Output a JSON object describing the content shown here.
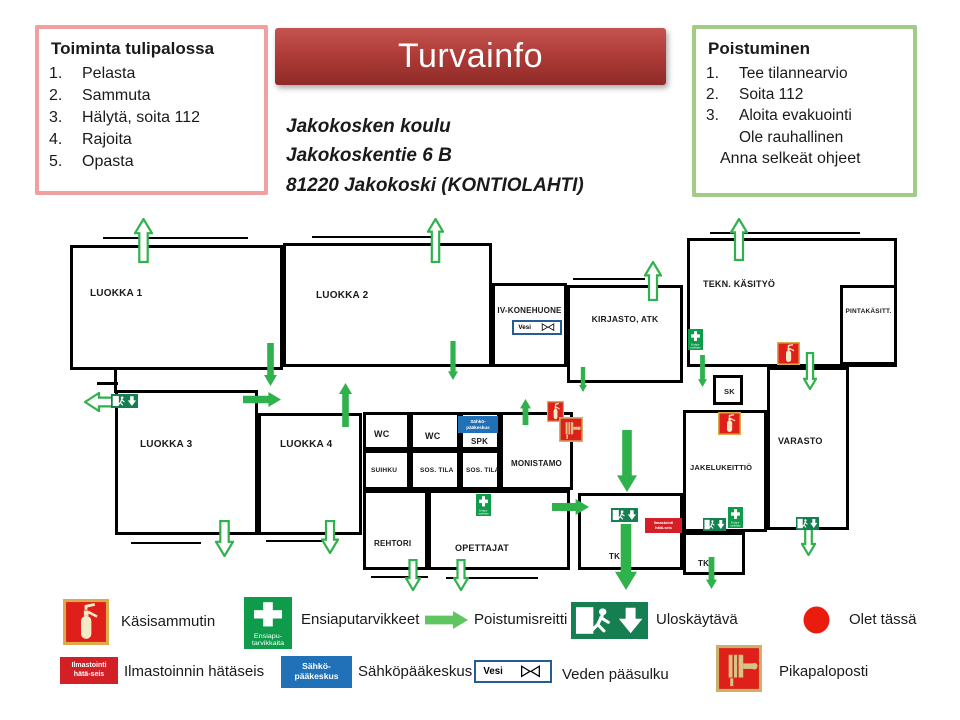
{
  "title": "Turvainfo",
  "address": {
    "line1": "Jakokosken koulu",
    "line2": "Jakokoskentie 6 B",
    "line3": "81220 Jakokoski (KONTIOLAHTI)"
  },
  "fire_instructions": {
    "title": "Toiminta  tulipalossa",
    "items": [
      "Pelasta",
      "Sammuta",
      "Hälytä, soita 112",
      "Rajoita",
      "Opasta"
    ]
  },
  "evacuation": {
    "title": "Poistuminen",
    "items": [
      "Tee tilannearvio",
      "Soita 112",
      "Aloita evakuointi"
    ],
    "extra1": "Ole rauhallinen",
    "extra2": "Anna selkeät ohjeet"
  },
  "colors": {
    "banner_red": "#b03c38",
    "pink_border": "#f0a0a0",
    "green_border": "#a2cb85",
    "route_green": "#2fb14c",
    "legend_arrow_green": "#5ec561",
    "exit_sign_green": "#157f52",
    "first_aid_green": "#0e9b4a",
    "alarm_red": "#d31f26",
    "electric_blue": "#2071b8",
    "dot_red": "#ea1c0d"
  },
  "sign_texts": {
    "ilmastointi_line1": "Ilmastointi",
    "ilmastointi_line2": "hätä-seis",
    "sahko_line1": "Sähkö-",
    "sahko_line2": "pääkeskus",
    "vesi": "Vesi",
    "ensiapu_line1": "Ensiapu-",
    "ensiapu_line2": "tarvikkaita"
  },
  "floorplan": {
    "rooms": [
      {
        "id": "luokka-1",
        "label": "LUOKKA 1",
        "x": 70,
        "y": 35,
        "w": 213,
        "h": 125,
        "lx": 17,
        "ly": 40,
        "fs": 10
      },
      {
        "id": "luokka-2",
        "label": "LUOKKA 2",
        "x": 283,
        "y": 33,
        "w": 209,
        "h": 124,
        "lx": 30,
        "ly": 44,
        "fs": 10
      },
      {
        "id": "iv-konehuone",
        "label": "IV-KONEHUONE",
        "x": 492,
        "y": 73,
        "w": 75,
        "h": 84,
        "lx": 0,
        "ly": 20,
        "fs": 8,
        "center": true
      },
      {
        "id": "kirjasto-atk",
        "label": "KIRJASTO, ATK",
        "x": 567,
        "y": 75,
        "w": 116,
        "h": 98,
        "lx": 0,
        "ly": 26,
        "fs": 8.5,
        "center": true
      },
      {
        "id": "tekn-kasityo",
        "label": "TEKN. KÄSITYÖ",
        "x": 687,
        "y": 28,
        "w": 210,
        "h": 129,
        "lx": 13,
        "ly": 38,
        "fs": 9
      },
      {
        "id": "pintakasitt",
        "label": "PINTAKÄSITT.",
        "x": 840,
        "y": 75,
        "w": 57,
        "h": 80,
        "lx": 0,
        "ly": 20,
        "fs": 6.5,
        "center": true
      },
      {
        "id": "sk",
        "label": "SK",
        "x": 713,
        "y": 165,
        "w": 30,
        "h": 30,
        "lx": 8,
        "ly": 9,
        "fs": 7.5
      },
      {
        "id": "varasto",
        "label": "VARASTO",
        "x": 767,
        "y": 157,
        "w": 82,
        "h": 163,
        "lx": 8,
        "ly": 66,
        "fs": 9
      },
      {
        "id": "jakelukeittio",
        "label": "JAKELUKEITTIÖ",
        "x": 683,
        "y": 200,
        "w": 84,
        "h": 122,
        "lx": 4,
        "ly": 50,
        "fs": 7.5
      },
      {
        "id": "luokka-3",
        "label": "LUOKKA 3",
        "x": 115,
        "y": 180,
        "w": 143,
        "h": 145,
        "lx": 22,
        "ly": 46,
        "fs": 10
      },
      {
        "id": "luokka-4",
        "label": "LUOKKA 4",
        "x": 258,
        "y": 203,
        "w": 104,
        "h": 122,
        "lx": 19,
        "ly": 23,
        "fs": 10
      },
      {
        "id": "wc-1",
        "label": "WC",
        "x": 363,
        "y": 202,
        "w": 47,
        "h": 38,
        "lx": 8,
        "ly": 14,
        "fs": 9
      },
      {
        "id": "wc-2",
        "label": "WC",
        "x": 410,
        "y": 202,
        "w": 50,
        "h": 38,
        "lx": 12,
        "ly": 16,
        "fs": 9
      },
      {
        "id": "spk",
        "label": "SPK",
        "x": 460,
        "y": 202,
        "w": 40,
        "h": 38,
        "lx": 8,
        "ly": 22,
        "fs": 8
      },
      {
        "id": "monistamo",
        "label": "MONISTAMO",
        "x": 500,
        "y": 202,
        "w": 73,
        "h": 78,
        "lx": 0,
        "ly": 44,
        "fs": 8,
        "center": true
      },
      {
        "id": "suihku",
        "label": "SUIHKU",
        "x": 363,
        "y": 240,
        "w": 47,
        "h": 40,
        "lx": 5,
        "ly": 14,
        "fs": 6.5
      },
      {
        "id": "sos-tila-1",
        "label": "SOS. TILA",
        "x": 410,
        "y": 240,
        "w": 50,
        "h": 40,
        "lx": 7,
        "ly": 14,
        "fs": 6.5
      },
      {
        "id": "sos-tila-2",
        "label": "SOS. TILA",
        "x": 460,
        "y": 240,
        "w": 40,
        "h": 40,
        "lx": 3,
        "ly": 14,
        "fs": 6.5
      },
      {
        "id": "rehtori",
        "label": "REHTORI",
        "x": 363,
        "y": 280,
        "w": 65,
        "h": 80,
        "lx": 8,
        "ly": 46,
        "fs": 8
      },
      {
        "id": "opettajat",
        "label": "OPETTAJAT",
        "x": 428,
        "y": 280,
        "w": 142,
        "h": 80,
        "lx": 24,
        "ly": 50,
        "fs": 9
      },
      {
        "id": "tk-1",
        "label": "TK",
        "x": 578,
        "y": 283,
        "w": 105,
        "h": 77,
        "lx": 28,
        "ly": 56,
        "fs": 8
      },
      {
        "id": "tk-2",
        "label": "TK",
        "x": 683,
        "y": 322,
        "w": 62,
        "h": 43,
        "lx": 12,
        "ly": 24,
        "fs": 8
      }
    ],
    "walls": [
      {
        "x": 103,
        "y": 27,
        "w": 145,
        "h": 2
      },
      {
        "x": 312,
        "y": 26,
        "w": 128,
        "h": 2
      },
      {
        "x": 573,
        "y": 68,
        "w": 72,
        "h": 2
      },
      {
        "x": 710,
        "y": 22,
        "w": 150,
        "h": 2
      },
      {
        "x": 131,
        "y": 332,
        "w": 70,
        "h": 2
      },
      {
        "x": 266,
        "y": 330,
        "w": 58,
        "h": 2
      },
      {
        "x": 371,
        "y": 366,
        "w": 57,
        "h": 2
      },
      {
        "x": 446,
        "y": 367,
        "w": 92,
        "h": 2
      },
      {
        "x": 97,
        "y": 172,
        "w": 21,
        "h": 3
      },
      {
        "x": 114,
        "y": 160,
        "w": 3,
        "h": 23
      }
    ],
    "arrows": [
      {
        "dir": "down",
        "style": "solid",
        "x": 263,
        "y": 132,
        "w": 15,
        "h": 45
      },
      {
        "dir": "right",
        "style": "solid",
        "x": 242,
        "y": 181,
        "w": 40,
        "h": 17
      },
      {
        "dir": "up",
        "style": "solid",
        "x": 338,
        "y": 172,
        "w": 15,
        "h": 46
      },
      {
        "dir": "down",
        "style": "solid",
        "x": 447,
        "y": 130,
        "w": 12,
        "h": 41
      },
      {
        "dir": "up",
        "style": "solid",
        "x": 519,
        "y": 188,
        "w": 13,
        "h": 28
      },
      {
        "dir": "down",
        "style": "solid",
        "x": 578,
        "y": 156,
        "w": 10,
        "h": 27
      },
      {
        "dir": "down",
        "style": "solid",
        "x": 697,
        "y": 144,
        "w": 11,
        "h": 34
      },
      {
        "dir": "down",
        "style": "solid",
        "x": 616,
        "y": 219,
        "w": 22,
        "h": 64
      },
      {
        "dir": "right",
        "style": "solid",
        "x": 551,
        "y": 288,
        "w": 39,
        "h": 18
      },
      {
        "dir": "down",
        "style": "solid",
        "x": 614,
        "y": 313,
        "w": 24,
        "h": 68
      },
      {
        "dir": "down",
        "style": "solid",
        "x": 705,
        "y": 346,
        "w": 13,
        "h": 34
      },
      {
        "dir": "up",
        "style": "outline",
        "x": 134,
        "y": 8,
        "w": 19,
        "h": 45
      },
      {
        "dir": "up",
        "style": "outline",
        "x": 427,
        "y": 8,
        "w": 17,
        "h": 45
      },
      {
        "dir": "up",
        "style": "outline",
        "x": 644,
        "y": 51,
        "w": 18,
        "h": 40
      },
      {
        "dir": "up",
        "style": "outline",
        "x": 730,
        "y": 8,
        "w": 18,
        "h": 43
      },
      {
        "dir": "left",
        "style": "outline",
        "x": 84,
        "y": 182,
        "w": 30,
        "h": 20
      },
      {
        "dir": "down",
        "style": "outline",
        "x": 215,
        "y": 310,
        "w": 19,
        "h": 37
      },
      {
        "dir": "down",
        "style": "outline",
        "x": 321,
        "y": 310,
        "w": 18,
        "h": 34
      },
      {
        "dir": "down",
        "style": "outline",
        "x": 405,
        "y": 349,
        "w": 16,
        "h": 32
      },
      {
        "dir": "down",
        "style": "outline",
        "x": 453,
        "y": 349,
        "w": 16,
        "h": 32
      },
      {
        "dir": "down",
        "style": "outline",
        "x": 803,
        "y": 142,
        "w": 14,
        "h": 38
      },
      {
        "dir": "down",
        "style": "outline",
        "x": 801,
        "y": 318,
        "w": 15,
        "h": 28
      }
    ],
    "icons": [
      {
        "type": "vesi",
        "x": 512,
        "y": 110,
        "w": 50,
        "h": 15
      },
      {
        "type": "sahko",
        "x": 458,
        "y": 206,
        "w": 40,
        "h": 17
      },
      {
        "type": "ilmastointi",
        "x": 645,
        "y": 308,
        "w": 37,
        "h": 15
      },
      {
        "type": "extinguisher",
        "x": 777,
        "y": 132,
        "w": 23,
        "h": 23
      },
      {
        "type": "extinguisher",
        "x": 718,
        "y": 202,
        "w": 23,
        "h": 23
      },
      {
        "type": "extinguisher",
        "x": 547,
        "y": 191,
        "w": 17,
        "h": 21
      },
      {
        "type": "firehose",
        "x": 559,
        "y": 207,
        "w": 24,
        "h": 25
      },
      {
        "type": "firstaid",
        "x": 688,
        "y": 119,
        "w": 15,
        "h": 21
      },
      {
        "type": "firstaid",
        "x": 728,
        "y": 297,
        "w": 15,
        "h": 21
      },
      {
        "type": "firstaid",
        "x": 476,
        "y": 284,
        "w": 15,
        "h": 22
      },
      {
        "type": "exitsign",
        "x": 111,
        "y": 184,
        "w": 27,
        "h": 14
      },
      {
        "type": "exitsign",
        "x": 611,
        "y": 298,
        "w": 27,
        "h": 14
      },
      {
        "type": "exitsign",
        "x": 703,
        "y": 308,
        "w": 23,
        "h": 13
      },
      {
        "type": "exitsign",
        "x": 796,
        "y": 307,
        "w": 23,
        "h": 13
      }
    ]
  },
  "legend": {
    "items": [
      {
        "type": "extinguisher",
        "label": "Käsisammutin",
        "ix": 63,
        "iy": 599,
        "iw": 46,
        "ih": 46,
        "tx": 121,
        "ty": 613
      },
      {
        "type": "firstaid",
        "label": "Ensiaputarvikkeet",
        "ix": 244,
        "iy": 597,
        "iw": 48,
        "ih": 52,
        "tx": 301,
        "ty": 611
      },
      {
        "type": "arrow",
        "label": "Poistumisreitti",
        "ix": 424,
        "iy": 610,
        "iw": 45,
        "ih": 20,
        "tx": 474,
        "ty": 611
      },
      {
        "type": "exitsign",
        "label": "Uloskäytävä",
        "ix": 571,
        "iy": 602,
        "iw": 77,
        "ih": 37,
        "tx": 656,
        "ty": 611
      },
      {
        "type": "reddot",
        "label": "Olet tässä",
        "ix": 803,
        "iy": 606,
        "iw": 27,
        "ih": 28,
        "tx": 849,
        "ty": 611
      },
      {
        "type": "ilmastointi",
        "label": "Ilmastoinnin hätäseis",
        "ix": 60,
        "iy": 657,
        "iw": 58,
        "ih": 27,
        "tx": 124,
        "ty": 663
      },
      {
        "type": "sahko",
        "label": "Sähköpääkeskus",
        "ix": 281,
        "iy": 656,
        "iw": 71,
        "ih": 32,
        "tx": 358,
        "ty": 663
      },
      {
        "type": "vesi",
        "label": "Veden pääsulku",
        "ix": 474,
        "iy": 660,
        "iw": 78,
        "ih": 23,
        "tx": 562,
        "ty": 666
      },
      {
        "type": "firehose",
        "label": "Pikapaloposti",
        "ix": 716,
        "iy": 645,
        "iw": 46,
        "ih": 47,
        "tx": 779,
        "ty": 663
      }
    ]
  }
}
